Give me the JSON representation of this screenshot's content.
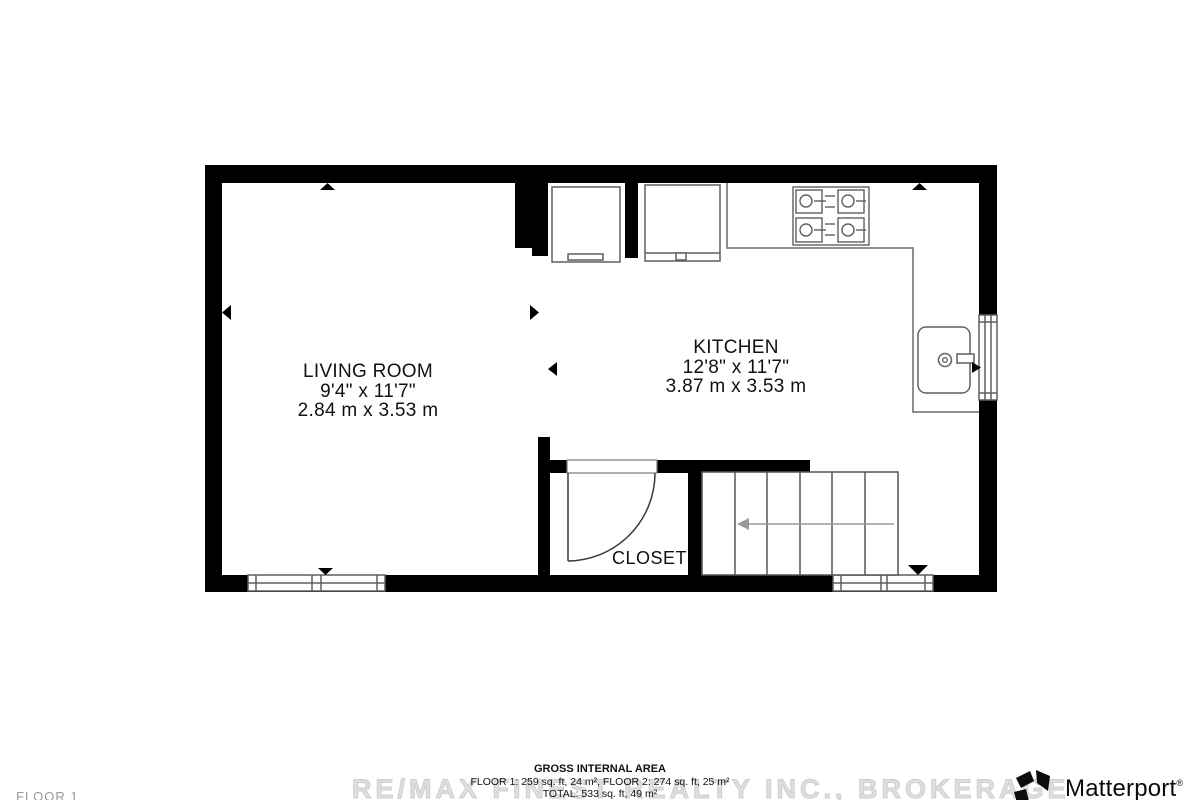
{
  "plan": {
    "rooms": {
      "living_room": {
        "name": "LIVING ROOM",
        "imperial": "9'4\" x 11'7\"",
        "metric": "2.84 m x 3.53 m"
      },
      "kitchen": {
        "name": "KITCHEN",
        "imperial": "12'8\" x 11'7\"",
        "metric": "3.87 m x 3.53 m"
      },
      "closet": {
        "name": "CLOSET"
      }
    }
  },
  "footer": {
    "heading": "GROSS INTERNAL AREA",
    "floors": "FLOOR 1: 259 sq. ft, 24 m², FLOOR 2: 274 sq. ft, 25 m²",
    "total": "TOTAL: 533 sq. ft, 49 m²"
  },
  "watermark": "RE/MAX FINEST REALTY INC., BROKERAGE",
  "floor_label": "FLOOR 1",
  "branding": {
    "wordmark": "Matterport",
    "registered": "®"
  },
  "colors": {
    "wall": "#000000",
    "fixture_outline": "#5f5f5f",
    "stair_arrow": "#9a9a9a",
    "watermark": "#dedede",
    "text": "#111111"
  }
}
